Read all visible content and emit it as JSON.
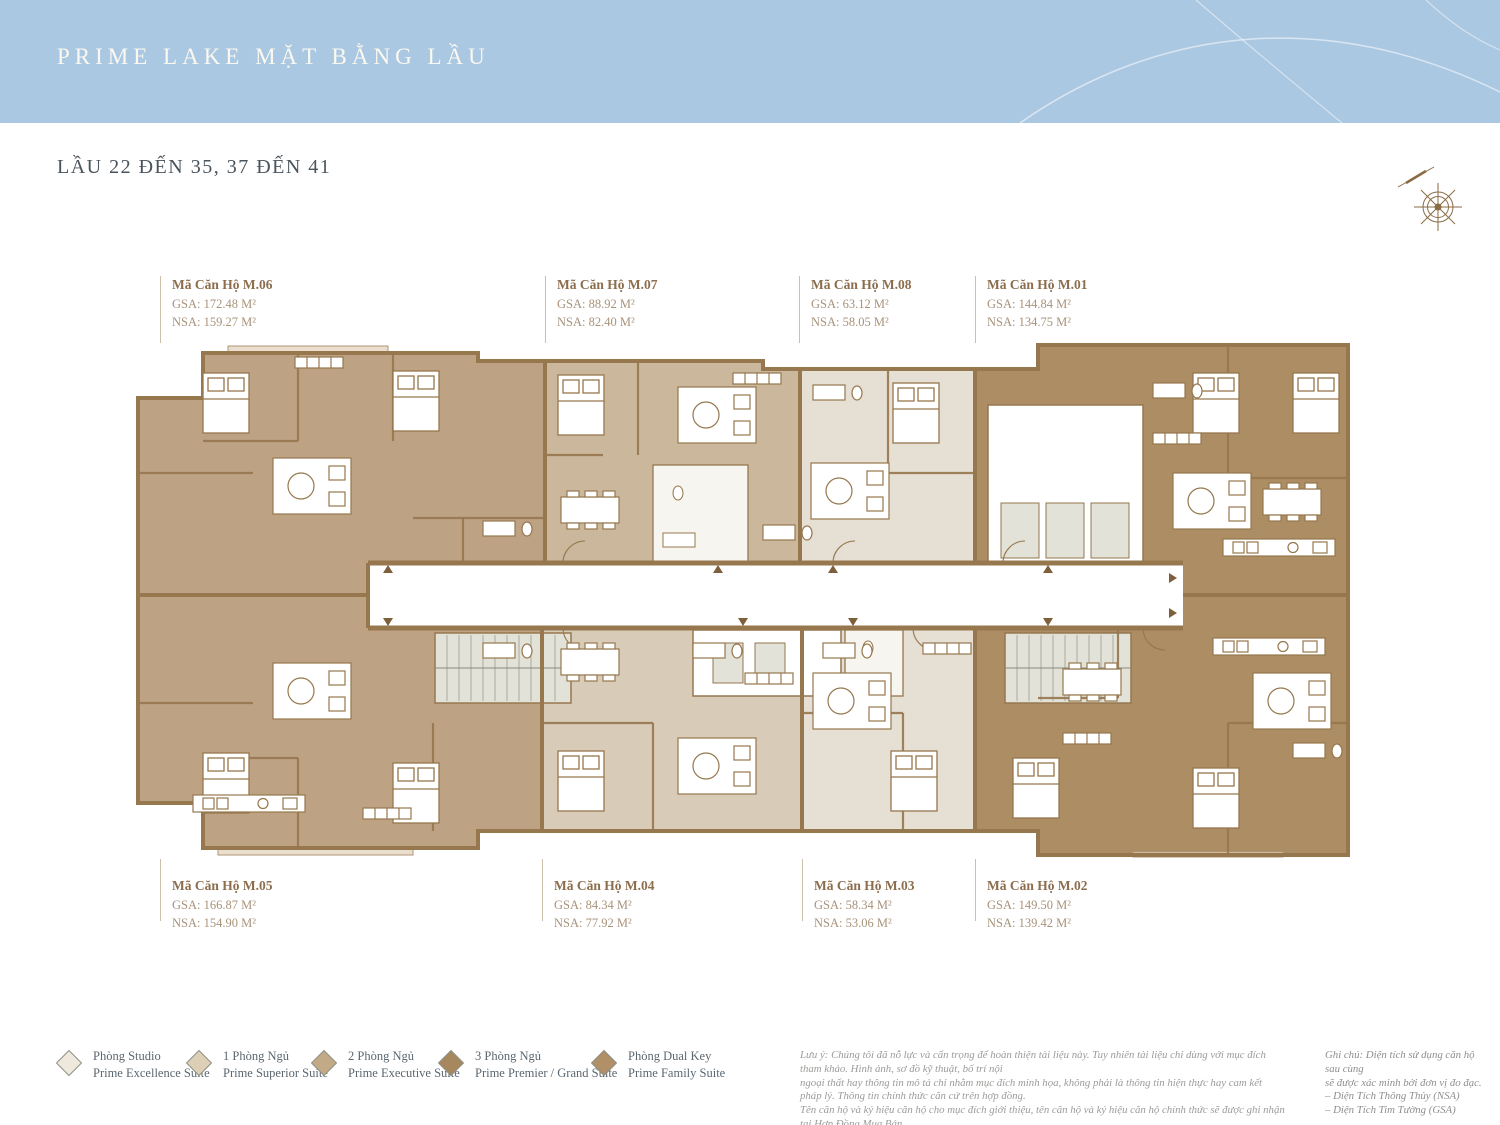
{
  "header": {
    "title": "PRIME LAKE MẶT BẰNG LẦU",
    "subtitle": "LẦU 22 ĐẾN 35, 37 ĐẾN 41"
  },
  "units": {
    "m06": {
      "name": "Mã Căn Hộ M.06",
      "gsa": "GSA: 172.48 M²",
      "nsa": "NSA: 159.27 M²"
    },
    "m07": {
      "name": "Mã Căn Hộ M.07",
      "gsa": "GSA: 88.92 M²",
      "nsa": "NSA: 82.40 M²"
    },
    "m08": {
      "name": "Mã Căn Hộ M.08",
      "gsa": "GSA: 63.12 M²",
      "nsa": "NSA: 58.05 M²"
    },
    "m01": {
      "name": "Mã Căn Hộ M.01",
      "gsa": "GSA: 144.84 M²",
      "nsa": "NSA: 134.75 M²"
    },
    "m05": {
      "name": "Mã Căn Hộ M.05",
      "gsa": "GSA: 166.87 M²",
      "nsa": "NSA: 154.90 M²"
    },
    "m04": {
      "name": "Mã Căn Hộ M.04",
      "gsa": "GSA: 84.34 M²",
      "nsa": "NSA: 77.92 M²"
    },
    "m03": {
      "name": "Mã Căn Hộ M.03",
      "gsa": "GSA: 58.34 M²",
      "nsa": "NSA: 53.06 M²"
    },
    "m02": {
      "name": "Mã Căn Hộ M.02",
      "gsa": "GSA: 149.50 M²",
      "nsa": "NSA: 139.42 M²"
    }
  },
  "legend": {
    "items": [
      {
        "vi": "Phòng Studio",
        "en": "Prime Excellence Suite",
        "color": "#eee9dc"
      },
      {
        "vi": "1 Phòng Ngủ",
        "en": "Prime Superior Suite",
        "color": "#dccfb6"
      },
      {
        "vi": "2 Phòng Ngủ",
        "en": "Prime Executive Suite",
        "color": "#c3aa86"
      },
      {
        "vi": "3 Phòng Ngủ",
        "en": "Prime Premier / Grand Suite",
        "color": "#a7875d"
      },
      {
        "vi": "Phòng Dual Key",
        "en": "Prime Family Suite",
        "color": "#b18f67"
      }
    ]
  },
  "disclaimer": {
    "line1": "Lưu ý: Chúng tôi đã nỗ lực và cẩn trọng để hoàn thiện tài liệu này. Tuy nhiên tài liệu chỉ dùng với mục đích tham khảo. Hình ảnh, sơ đồ kỹ thuật, bố trí nội",
    "line2": "ngoại thất hay thông tin mô tả chỉ nhằm mục đích minh họa, không phải là thông tin hiện thực hay cam kết pháp lý. Thông tin chính thức căn cứ trên hợp đồng.",
    "line3": "Tên căn hộ và ký hiệu căn hộ cho mục đích giới thiệu, tên căn hộ và ký hiệu căn hộ chính thức sẽ được ghi nhận tại Hợp Đồng Mua Bán."
  },
  "note": {
    "line1": "Ghi chú: Diện tích sử dụng căn hộ sau cùng",
    "line2": "sẽ được xác minh bởi đơn vị đo đạc.",
    "line3": "– Diện Tích Thông Thủy (NSA)",
    "line4": "– Diện Tích Tim Tường (GSA)"
  },
  "colors": {
    "header_blue": "#abc8e2",
    "wall_brown": "#96774e",
    "fill_3br": "#bea284",
    "fill_2br": "#cbb89c",
    "fill_1br": "#e6dfd3",
    "fill_dualkey": "#ac8d64",
    "core_gray": "#e2e2d8",
    "label_brown": "#8c6e4e"
  }
}
